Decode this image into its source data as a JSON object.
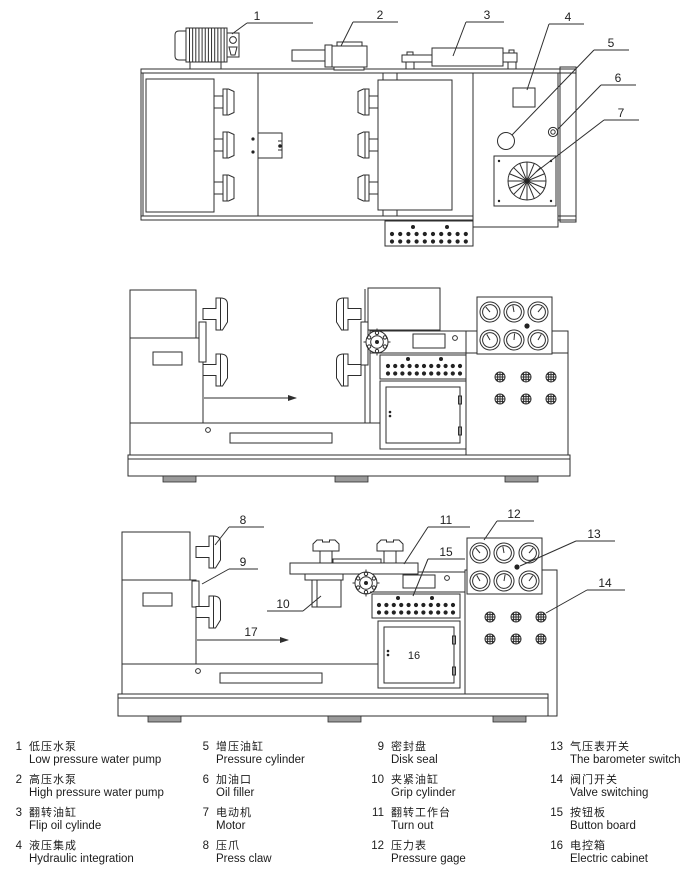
{
  "callouts": {
    "n1": "1",
    "n2": "2",
    "n3": "3",
    "n4": "4",
    "n5": "5",
    "n6": "6",
    "n7": "7",
    "n8": "8",
    "n9": "9",
    "n10": "10",
    "n11": "11",
    "n12": "12",
    "n13": "13",
    "n14": "14",
    "n15": "15",
    "n16": "16",
    "n17": "17"
  },
  "legend": {
    "items": [
      {
        "num": "1",
        "zh": "低压水泵",
        "en": "Low pressure water pump"
      },
      {
        "num": "2",
        "zh": "高压水泵",
        "en": "High pressure water pump"
      },
      {
        "num": "3",
        "zh": "翻转油缸",
        "en": "Flip oil cylinde"
      },
      {
        "num": "4",
        "zh": "液压集成",
        "en": "Hydraulic integration"
      },
      {
        "num": "5",
        "zh": "增压油缸",
        "en": "Pressure cylinder"
      },
      {
        "num": "6",
        "zh": "加油口",
        "en": "Oil filler"
      },
      {
        "num": "7",
        "zh": "电动机",
        "en": "Motor"
      },
      {
        "num": "8",
        "zh": "压爪",
        "en": "Press claw"
      },
      {
        "num": "9",
        "zh": "密封盘",
        "en": "Disk seal"
      },
      {
        "num": "10",
        "zh": "夹紧油缸",
        "en": "Grip cylinder"
      },
      {
        "num": "11",
        "zh": "翻转工作台",
        "en": "Turn out"
      },
      {
        "num": "12",
        "zh": "压力表",
        "en": "Pressure gage"
      },
      {
        "num": "13",
        "zh": "气压表开关",
        "en": "The barometer switch"
      },
      {
        "num": "14",
        "zh": "阀门开关",
        "en": "Valve switching"
      },
      {
        "num": "15",
        "zh": "按钮板",
        "en": "Button board"
      },
      {
        "num": "16",
        "zh": "电控箱",
        "en": "Electric cabinet"
      }
    ]
  }
}
